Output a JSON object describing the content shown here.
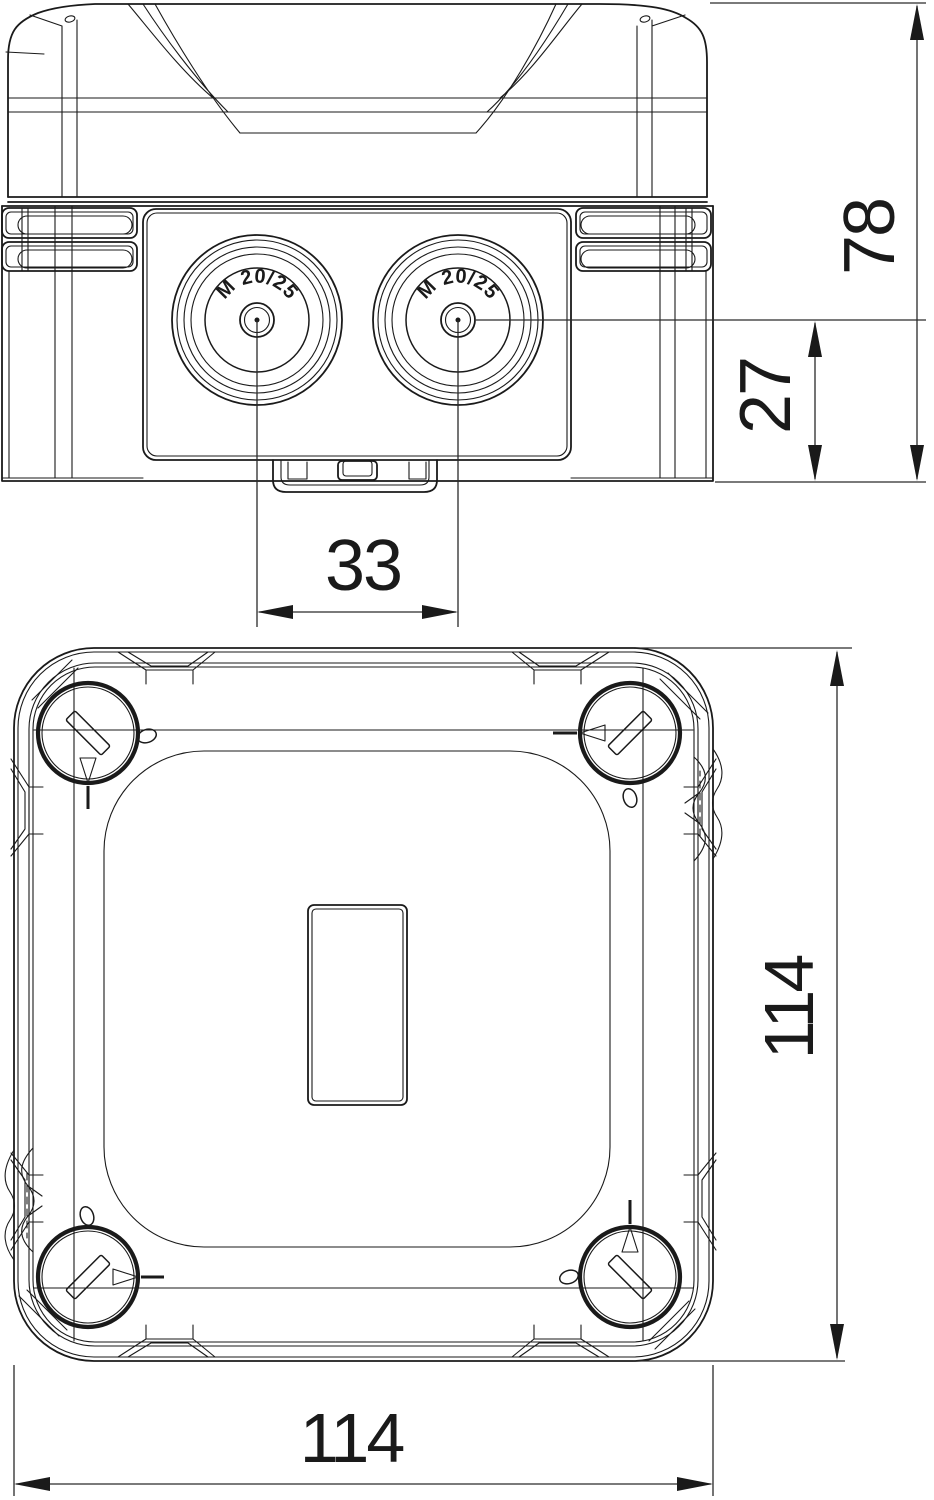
{
  "side_view": {
    "dim_total_height": "78",
    "dim_entry_center_height": "27",
    "dim_entry_spacing": "33",
    "entry_left_label": "M 20/25",
    "entry_right_label": "M 20/25"
  },
  "plan_view": {
    "dim_height": "114",
    "dim_width": "114"
  },
  "colors": {
    "line": "#1a1a1a",
    "dimension": "#2a2a2a",
    "background": "#ffffff"
  }
}
